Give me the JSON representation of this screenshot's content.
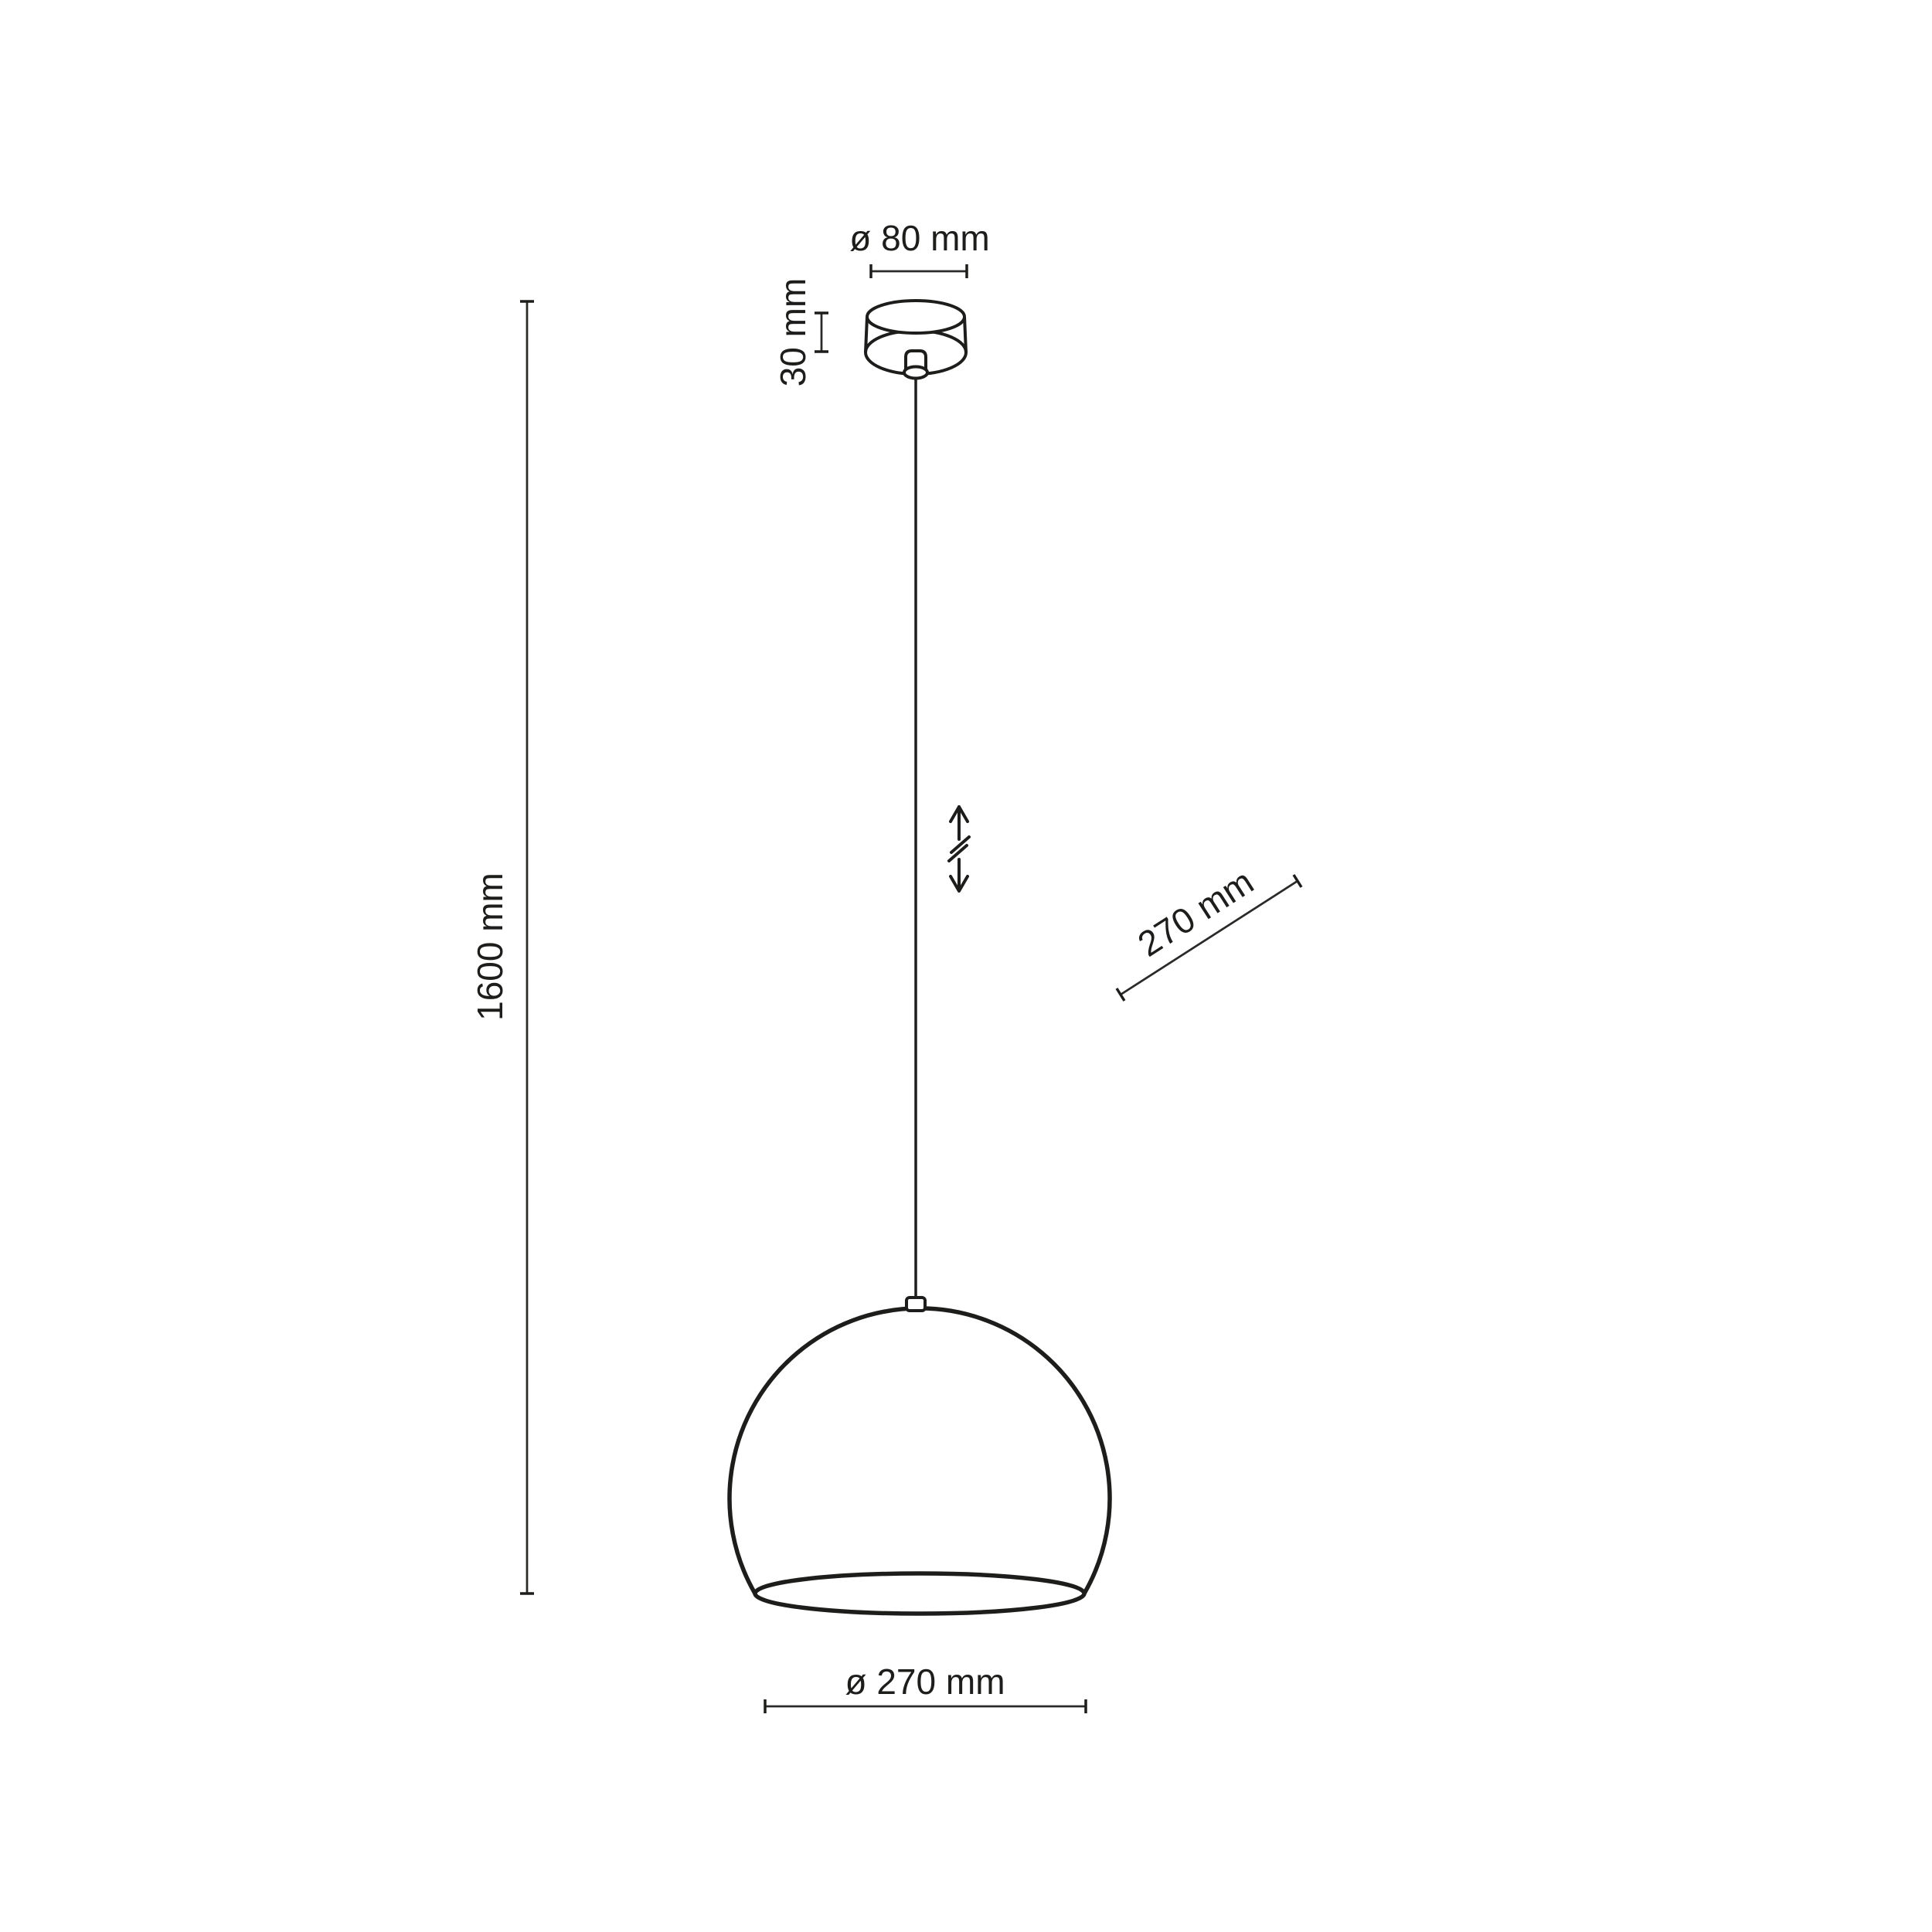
{
  "page": {
    "background_color": "#ffffff",
    "line_color": "#1d1d1b",
    "dim_line_color": "#2a2a28",
    "text_color": "#1d1d1b"
  },
  "diagram": {
    "kind": "pendant-lamp-dimension-drawing",
    "labels": {
      "canopy_diameter": "ø 80 mm",
      "canopy_height": "30 mm",
      "overall_height": "1600 mm",
      "shade_diagonal_diameter": "270 mm",
      "shade_bottom_diameter": "ø 270 mm"
    },
    "values_mm": {
      "canopy_diameter": 80,
      "canopy_height": 30,
      "overall_height": 1600,
      "shade_diameter": 270
    },
    "symbols": {
      "height_adjustable": "double-arrow-with-break"
    }
  }
}
